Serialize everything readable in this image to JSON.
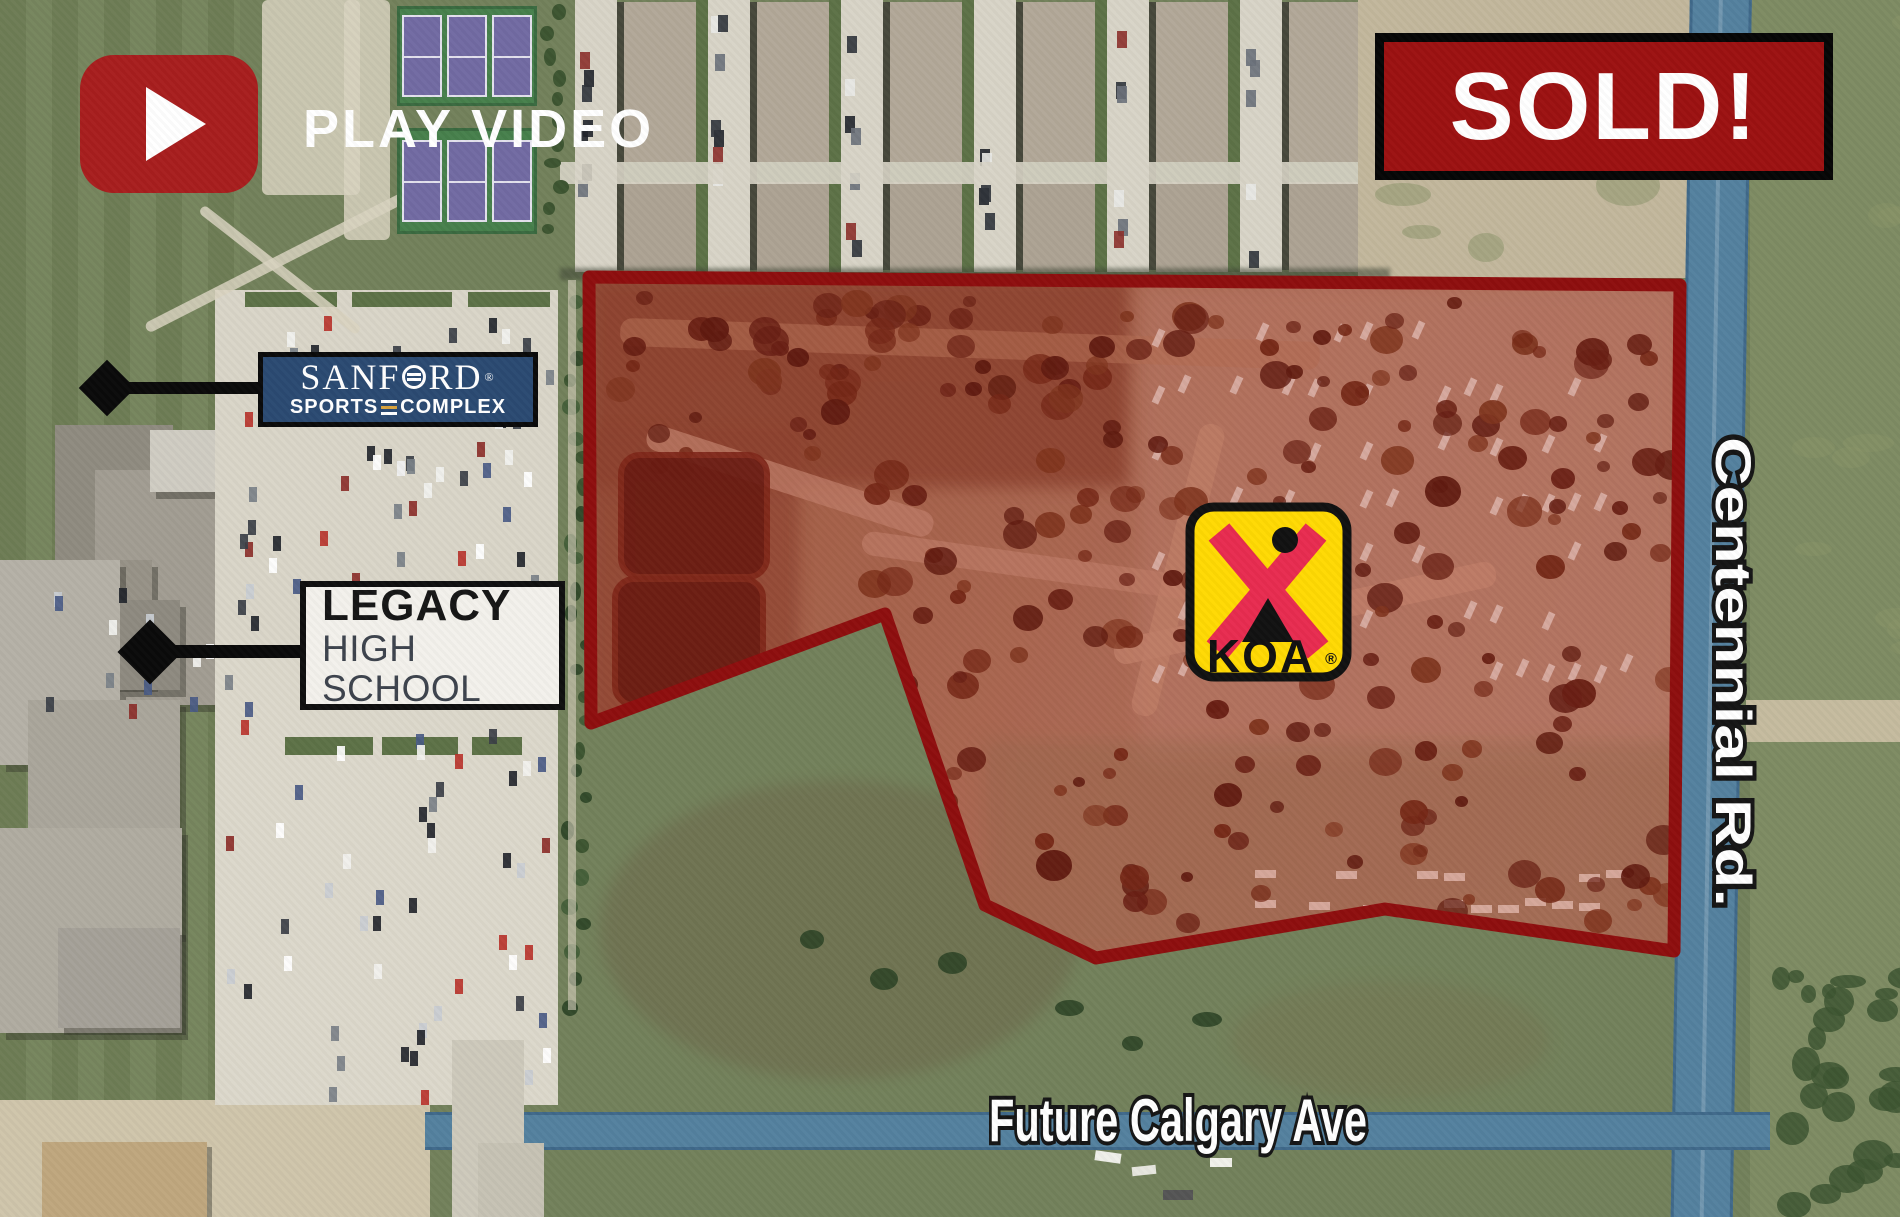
{
  "play": {
    "label": "PLAY VIDEO"
  },
  "sold": {
    "label": "SOLD!"
  },
  "labels": {
    "sanford": {
      "line1_pre": "SANF",
      "line1_post": "RD",
      "reg": "®",
      "line2_left": "SPORTS",
      "line2_right": "COMPLEX"
    },
    "legacy": {
      "line1": "LEGACY",
      "line2": "HIGH SCHOOL"
    }
  },
  "roads": {
    "vertical": "Centennial Rd.",
    "horizontal": "Future Calgary Ave"
  },
  "koa": {
    "text": "KOA",
    "reg": "®"
  },
  "colors": {
    "boundary_red": "#8e0e0e",
    "sold_red": "#9c1111",
    "play_red": "#a81e1e",
    "sanford_navy": "#2b4a72",
    "sanford_gold": "#d9a33c",
    "koa_yellow": "#ffd903",
    "koa_x_red": "#e82c50",
    "road_blue": "#54819f"
  }
}
